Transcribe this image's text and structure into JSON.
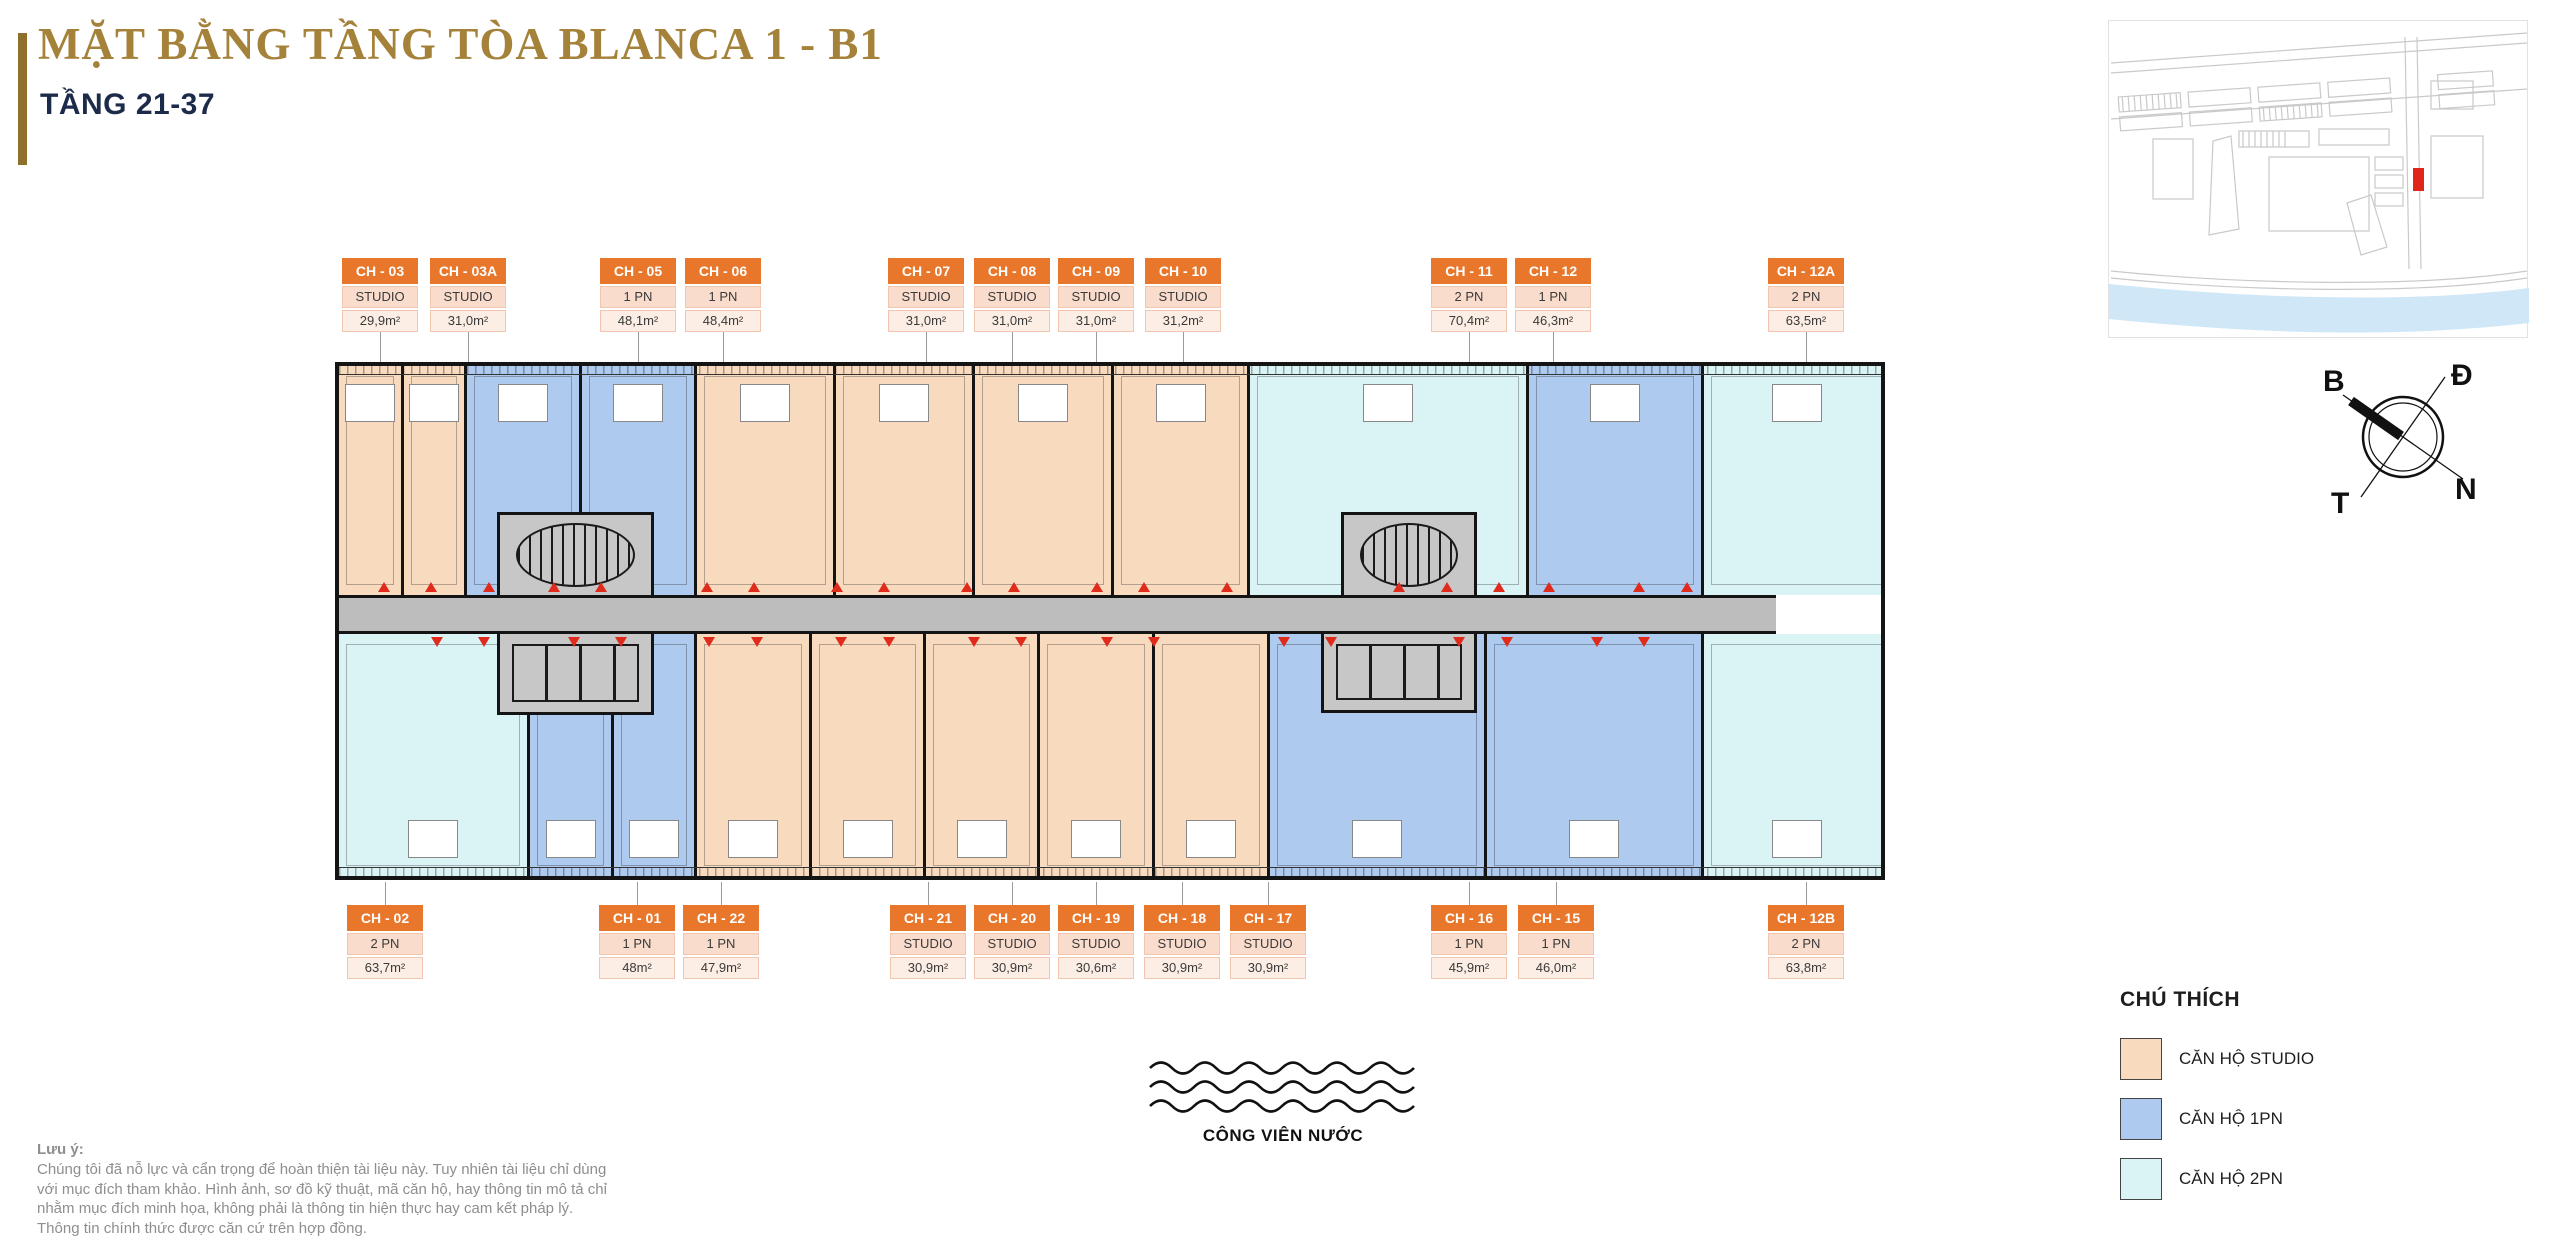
{
  "header": {
    "title": "MẶT BẰNG TẦNG TÒA BLANCA 1 - B1",
    "subtitle": "TẦNG 21-37"
  },
  "units_top": [
    {
      "code": "CH - 03",
      "type": "STUDIO",
      "area": "29,9m²",
      "x": 380
    },
    {
      "code": "CH - 03A",
      "type": "STUDIO",
      "area": "31,0m²",
      "x": 468
    },
    {
      "code": "CH - 05",
      "type": "1 PN",
      "area": "48,1m²",
      "x": 638
    },
    {
      "code": "CH - 06",
      "type": "1 PN",
      "area": "48,4m²",
      "x": 723
    },
    {
      "code": "CH - 07",
      "type": "STUDIO",
      "area": "31,0m²",
      "x": 926
    },
    {
      "code": "CH - 08",
      "type": "STUDIO",
      "area": "31,0m²",
      "x": 1012
    },
    {
      "code": "CH - 09",
      "type": "STUDIO",
      "area": "31,0m²",
      "x": 1096
    },
    {
      "code": "CH - 10",
      "type": "STUDIO",
      "area": "31,2m²",
      "x": 1183
    },
    {
      "code": "CH - 11",
      "type": "2 PN",
      "area": "70,4m²",
      "x": 1469
    },
    {
      "code": "CH - 12",
      "type": "1 PN",
      "area": "46,3m²",
      "x": 1553
    },
    {
      "code": "CH - 12A",
      "type": "2 PN",
      "area": "63,5m²",
      "x": 1806
    }
  ],
  "units_bottom": [
    {
      "code": "CH - 02",
      "type": "2 PN",
      "area": "63,7m²",
      "x": 385
    },
    {
      "code": "CH - 01",
      "type": "1 PN",
      "area": "48m²",
      "x": 637
    },
    {
      "code": "CH - 22",
      "type": "1 PN",
      "area": "47,9m²",
      "x": 721
    },
    {
      "code": "CH - 21",
      "type": "STUDIO",
      "area": "30,9m²",
      "x": 928
    },
    {
      "code": "CH - 20",
      "type": "STUDIO",
      "area": "30,9m²",
      "x": 1012
    },
    {
      "code": "CH - 19",
      "type": "STUDIO",
      "area": "30,6m²",
      "x": 1096
    },
    {
      "code": "CH - 18",
      "type": "STUDIO",
      "area": "30,9m²",
      "x": 1182
    },
    {
      "code": "CH - 17",
      "type": "STUDIO",
      "area": "30,9m²",
      "x": 1268
    },
    {
      "code": "CH - 16",
      "type": "1 PN",
      "area": "45,9m²",
      "x": 1469
    },
    {
      "code": "CH - 15",
      "type": "1 PN",
      "area": "46,0m²",
      "x": 1556
    },
    {
      "code": "CH - 12B",
      "type": "2 PN",
      "area": "63,8m²",
      "x": 1806
    }
  ],
  "plan": {
    "top_segments": [
      {
        "code": "CH - 03",
        "type": "studio",
        "x": 0,
        "w": 62
      },
      {
        "code": "CH - 03A",
        "type": "studio",
        "x": 62,
        "w": 63
      },
      {
        "code": "CH - 05",
        "type": "pn1",
        "x": 125,
        "w": 115
      },
      {
        "code": "CH - 06",
        "type": "pn1",
        "x": 240,
        "w": 115
      },
      {
        "code": "CH - 07",
        "type": "studio",
        "x": 355,
        "w": 139
      },
      {
        "code": "CH - 08",
        "type": "studio",
        "x": 494,
        "w": 139
      },
      {
        "code": "CH - 09",
        "type": "studio",
        "x": 633,
        "w": 139
      },
      {
        "code": "CH - 10",
        "type": "studio",
        "x": 772,
        "w": 136
      },
      {
        "code": "CH - 11",
        "type": "pn2",
        "x": 908,
        "w": 279
      },
      {
        "code": "CH - 12",
        "type": "pn1",
        "x": 1187,
        "w": 175
      },
      {
        "code": "CH - 12A",
        "type": "pn2",
        "x": 1362,
        "w": 188
      }
    ],
    "bottom_segments": [
      {
        "code": "CH - 02",
        "type": "pn2",
        "x": 0,
        "w": 188
      },
      {
        "code": "CH - 01",
        "type": "pn1",
        "x": 188,
        "w": 84
      },
      {
        "code": "CH - 22",
        "type": "pn1",
        "x": 272,
        "w": 83
      },
      {
        "code": "CH - 21",
        "type": "studio",
        "x": 355,
        "w": 115
      },
      {
        "code": "CH - 20",
        "type": "studio",
        "x": 470,
        "w": 114
      },
      {
        "code": "CH - 19",
        "type": "studio",
        "x": 584,
        "w": 114
      },
      {
        "code": "CH - 18",
        "type": "studio",
        "x": 698,
        "w": 115
      },
      {
        "code": "CH - 17",
        "type": "studio",
        "x": 813,
        "w": 115
      },
      {
        "code": "CH - 16",
        "type": "pn1",
        "x": 928,
        "w": 217
      },
      {
        "code": "CH - 15",
        "type": "pn1",
        "x": 1145,
        "w": 217
      },
      {
        "code": "CH - 12B",
        "type": "pn2",
        "x": 1362,
        "w": 188
      }
    ],
    "entry_markers_top_x": [
      45,
      92,
      150,
      215,
      262,
      368,
      415,
      498,
      545,
      628,
      675,
      758,
      805,
      888,
      1060,
      1108,
      1160,
      1210,
      1300,
      1348
    ],
    "entry_markers_bottom_x": [
      98,
      145,
      235,
      282,
      370,
      418,
      502,
      550,
      635,
      682,
      768,
      815,
      945,
      992,
      1120,
      1168,
      1258,
      1305
    ]
  },
  "legend": {
    "title": "CHÚ THÍCH",
    "items": [
      {
        "label": "CĂN HỘ STUDIO",
        "color": "#f8dbbf"
      },
      {
        "label": "CĂN HỘ 1PN",
        "color": "#aecbef"
      },
      {
        "label": "CĂN HỘ 2PN",
        "color": "#daf4f5"
      }
    ]
  },
  "compass": {
    "north": "B",
    "east": "Đ",
    "south": "N",
    "west": "T"
  },
  "water_park": {
    "label": "CÔNG VIÊN NƯỚC"
  },
  "note": {
    "heading": "Lưu ý:",
    "lines": [
      "Chúng tôi đã nỗ lực và cẩn trọng để hoàn thiện tài liệu này. Tuy nhiên tài liệu chỉ dùng",
      "với mục đích tham khảo. Hình ảnh, sơ đồ kỹ thuật, mã căn hộ, hay thông tin mô tả chỉ",
      "nhằm mục đích minh họa, không phải là thông tin hiện thực hay cam kết pháp lý.",
      "Thông tin chính thức được căn cứ trên hợp đồng."
    ]
  },
  "colors": {
    "studio": "#f8dbbf",
    "one_bedroom": "#aecbef",
    "two_bedroom": "#daf4f5",
    "unit_header": "#e8772b",
    "title_gold": "#a5823a",
    "subtitle_navy": "#1c2b4a",
    "corridor_gray": "#bdbdbd",
    "marker_red": "#e02a1c"
  }
}
